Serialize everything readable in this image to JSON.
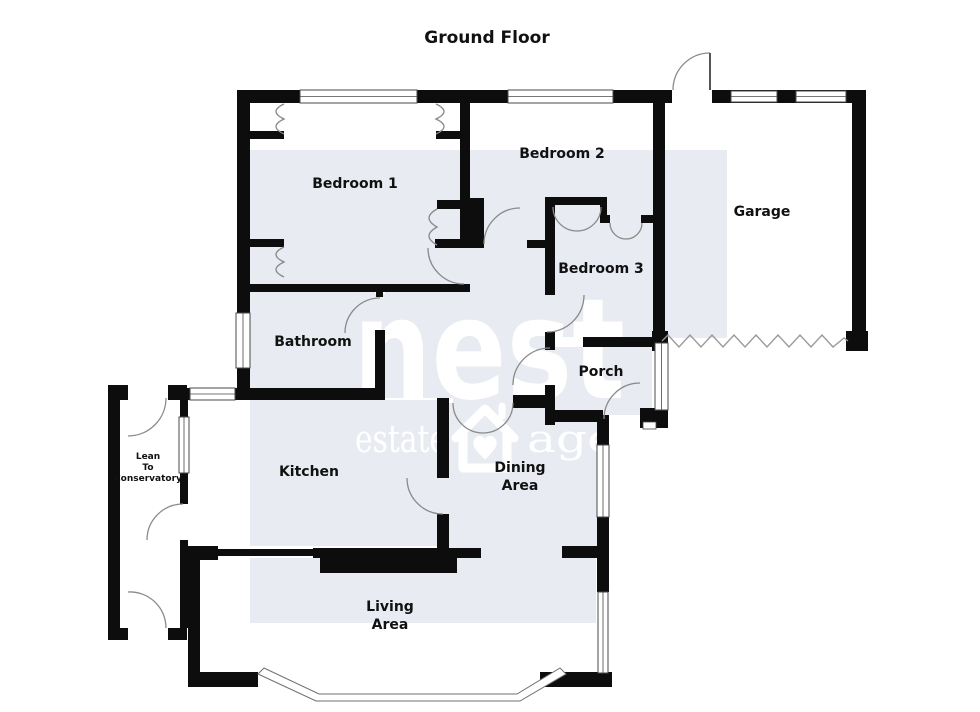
{
  "title": "Ground Floor",
  "colors": {
    "wall": "#0d0d0d",
    "floor_tint": "#e8ebf1",
    "door_arc": "#8a8a8a",
    "watermark": "#ffffff",
    "background": "#ffffff"
  },
  "rooms": {
    "bedroom1": {
      "label": "Bedroom 1"
    },
    "bedroom2": {
      "label": "Bedroom 2"
    },
    "bedroom3": {
      "label": "Bedroom 3"
    },
    "garage": {
      "label": "Garage"
    },
    "bathroom": {
      "label": "Bathroom"
    },
    "porch": {
      "label": "Porch"
    },
    "kitchen": {
      "label": "Kitchen"
    },
    "dining": {
      "line1": "Dining",
      "line2": "Area"
    },
    "living": {
      "line1": "Living",
      "line2": "Area"
    },
    "conservatory": {
      "line1": "Lean",
      "line2": "To",
      "line3": "Conservatory"
    }
  },
  "watermark": {
    "word1": "nest",
    "word2": "estate",
    "word3": "agents",
    "icon": "house-heart-icon"
  }
}
